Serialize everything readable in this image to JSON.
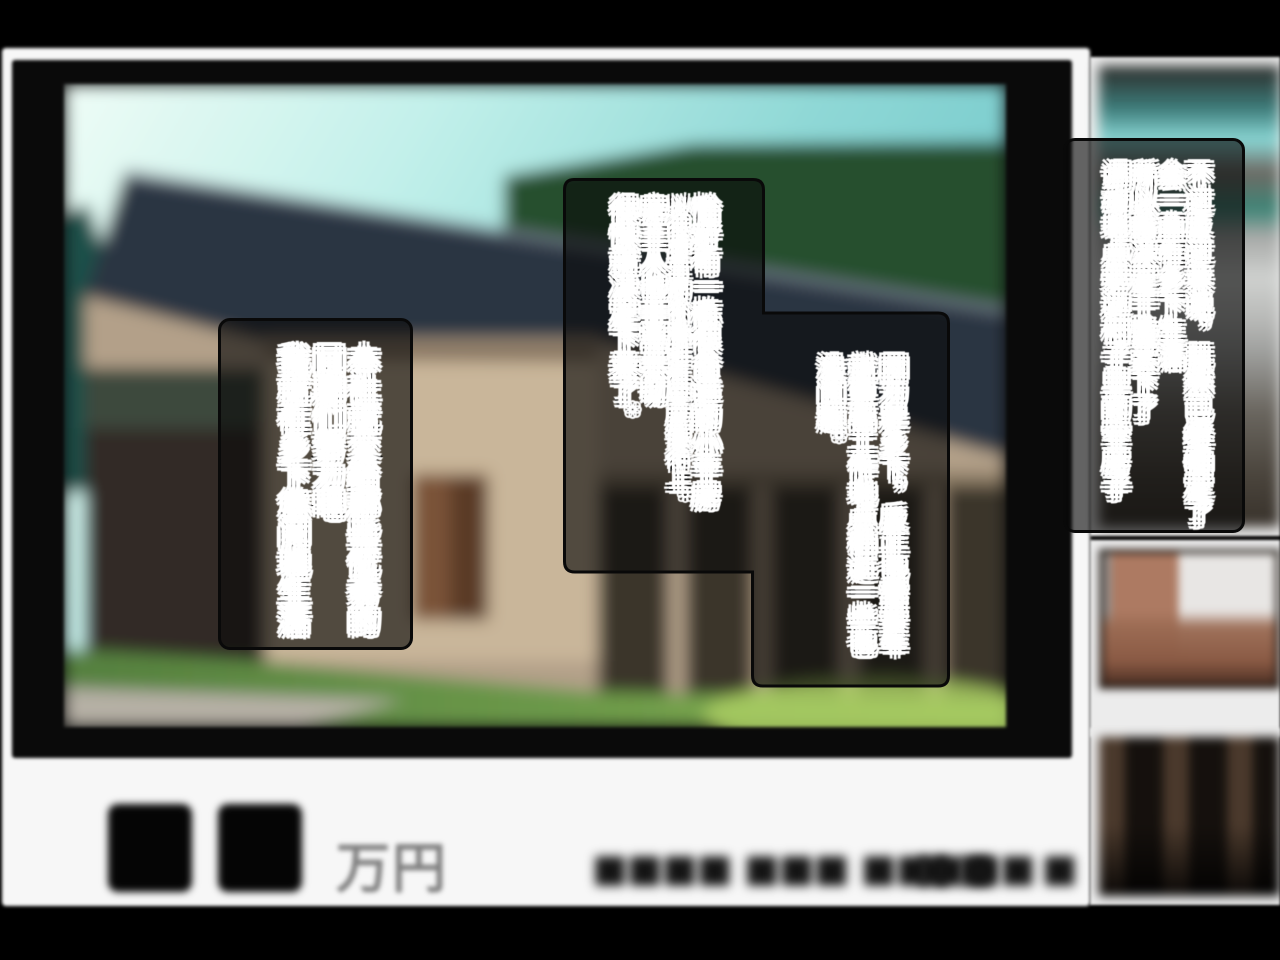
{
  "speech": {
    "left": {
      "lines": [
        "本社就交给那些优秀的",
        "同期们努力吧",
        "我就在乡下悠闲地生活"
      ]
    },
    "center": {
      "lines": [
        "恰好有一栋很合适的小平房",
        "以很便宜的价格挂在空房银行上。",
        "房主人也非常亲切",
        "很快就决定下来了。"
      ]
    },
    "center_lower": {
      "lines": [
        "因为是乡下，反正也需要车",
        "就算离工作地点稍远一些也",
        "没问题。"
      ]
    },
    "right": {
      "lines": [
        "不过反过来说，既然已经确定了",
        "会一直在乡下生活",
        "所以我决定干脆买下了",
        "调动地点旁边村子里的空房子"
      ]
    }
  },
  "caption": {
    "price_unit": "万円",
    "censored_left": "■■■■ ■■■ ■■■■",
    "censored_right": "■■■■"
  },
  "colors": {
    "page_bg": "#000000",
    "card_bg": "#f7f7f7",
    "mat": "#0a0a0a",
    "bubble_fill": "rgba(8,8,8,0.62)",
    "bubble_border": "#090909",
    "speech_fill": "#ffffff",
    "speech_outline": "#000000",
    "price_text": "#7f7f7f",
    "sky": "#8fd8d6",
    "roof": "#2c3542",
    "wall": "#b3a089",
    "grass": "#6f9c4a"
  }
}
